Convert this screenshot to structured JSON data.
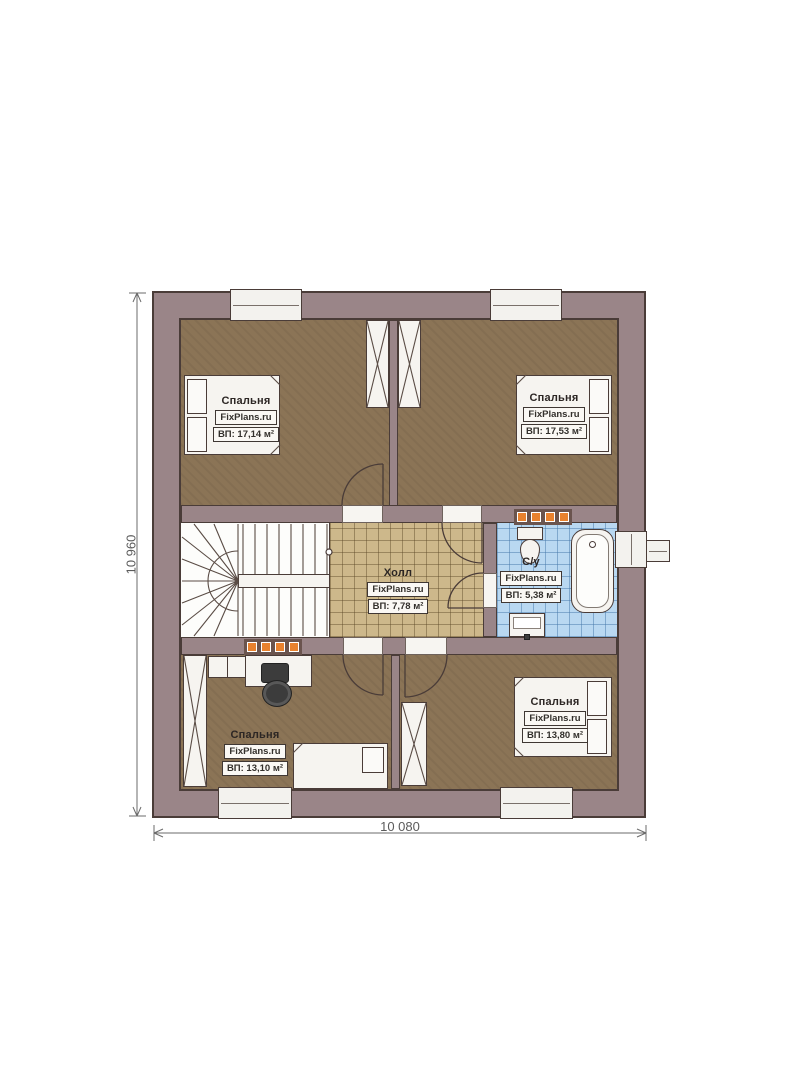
{
  "plan": {
    "title": "floor-plan-second-level",
    "brand": "FixPlans.ru"
  },
  "rooms": {
    "bedroom_tl": {
      "name": "Спальня",
      "brand": "FixPlans.ru",
      "area": "ВП: 17,14 м²"
    },
    "bedroom_tr": {
      "name": "Спальня",
      "brand": "FixPlans.ru",
      "area": "ВП: 17,53 м²"
    },
    "hall": {
      "name": "Холл",
      "brand": "FixPlans.ru",
      "area": "ВП: 7,78 м²"
    },
    "bathroom": {
      "name": "С/у",
      "brand": "FixPlans.ru",
      "area": "ВП: 5,38 м²"
    },
    "bedroom_bl": {
      "name": "Спальня",
      "brand": "FixPlans.ru",
      "area": "ВП: 13,10 м²"
    },
    "bedroom_br": {
      "name": "Спальня",
      "brand": "FixPlans.ru",
      "area": "ВП: 13,80 м²"
    }
  },
  "dimensions": {
    "height_label": "10 960",
    "width_label": "10 080"
  },
  "colors": {
    "wall": "#9a8588",
    "ink": "#4a3c38",
    "floor": "#8b7456",
    "hall_tile": "#cdb88b",
    "bath_tile": "#b9d8f1",
    "radiator": "#e8822f",
    "furniture": "#f6f4f0",
    "dim": "#5b5b5b"
  }
}
